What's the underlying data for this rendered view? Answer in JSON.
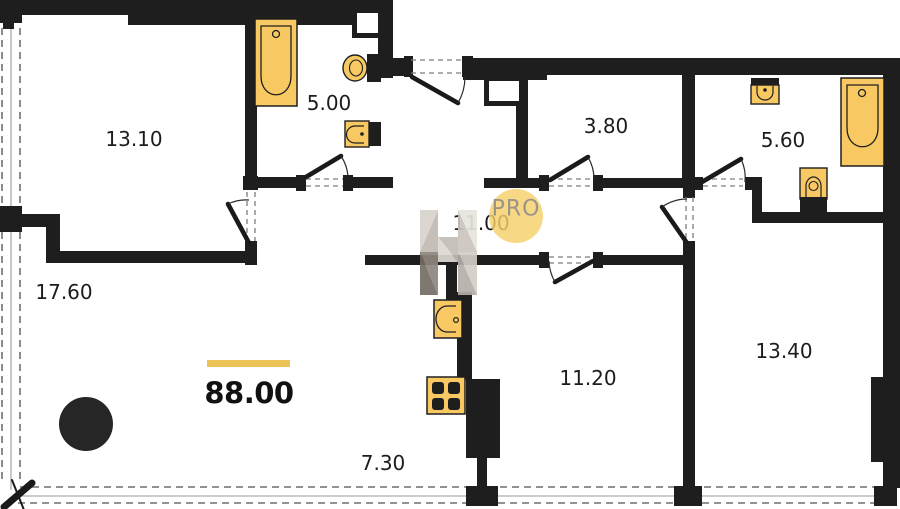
{
  "plan": {
    "title": "apartment-floor-plan",
    "total_area": "88.00",
    "rooms": [
      {
        "id": "bedroom-top-left",
        "area": "13.10"
      },
      {
        "id": "bathroom-left",
        "area": "5.00"
      },
      {
        "id": "storage-room",
        "area": "3.80"
      },
      {
        "id": "bathroom-right",
        "area": "5.60"
      },
      {
        "id": "hallway",
        "area": "11.00"
      },
      {
        "id": "living-room",
        "area": "17.60"
      },
      {
        "id": "bedroom-middle",
        "area": "11.20"
      },
      {
        "id": "bedroom-right",
        "area": "13.40"
      },
      {
        "id": "kitchen-zone",
        "area": "7.30"
      }
    ],
    "watermark": {
      "label": "PRO"
    },
    "icons": [
      "bathtub-icon",
      "toilet-icon",
      "sink-icon",
      "kitchen-sink-icon",
      "stove-icon",
      "refrigerator-block",
      "column",
      "door-swing",
      "window-glazing"
    ],
    "colors": {
      "wall": "#1E1E1E",
      "fixture_fill": "#F8C963",
      "fixture_stroke": "#1F1F1F",
      "accent_bar": "#EDC355",
      "watermark_circle": "#F5D069",
      "watermark_text": "#9B948A",
      "label_text": "#1C1C1C"
    }
  }
}
